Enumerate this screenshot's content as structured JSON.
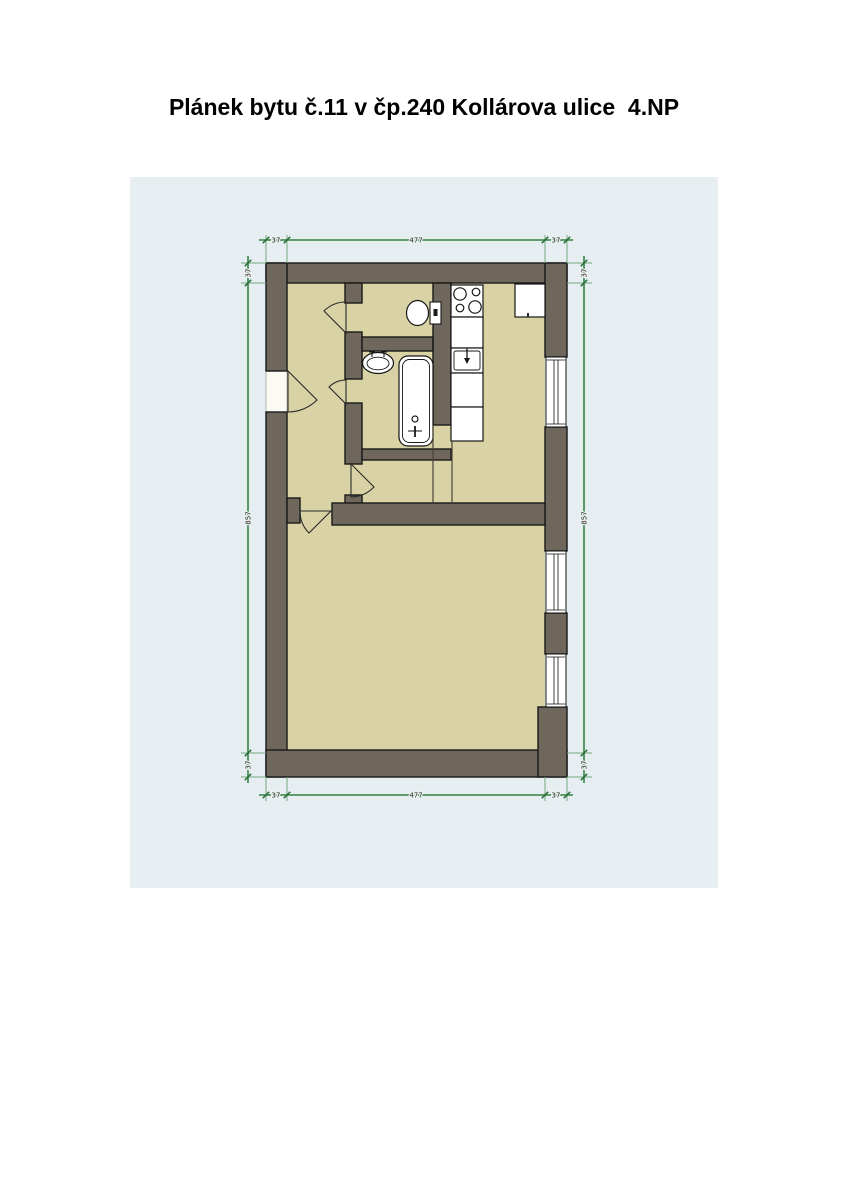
{
  "page": {
    "title": "Plánek bytu č.11 v čp.240 Kollárova ulice  4.NP"
  },
  "plan": {
    "dimensions": {
      "top": [
        "37",
        "477",
        "37"
      ],
      "bottom": [
        "37",
        "477",
        "37"
      ],
      "left": [
        "37",
        "857",
        "37"
      ],
      "right": [
        "37",
        "857",
        "37"
      ]
    },
    "colors": {
      "canvas_background": "#e7eef2",
      "floor": "#d9d2a4",
      "wall": "#6f675c",
      "outline": "#191919",
      "fixture_fill": "#ffffff",
      "dimension_green": "#4b9159"
    },
    "fixtures": [
      "four-burner-stove",
      "refrigerator",
      "kitchen-counter",
      "kitchen-sink",
      "washbasin",
      "bathtub",
      "toilet",
      "entrance-door",
      "interior-doors",
      "windows"
    ]
  }
}
